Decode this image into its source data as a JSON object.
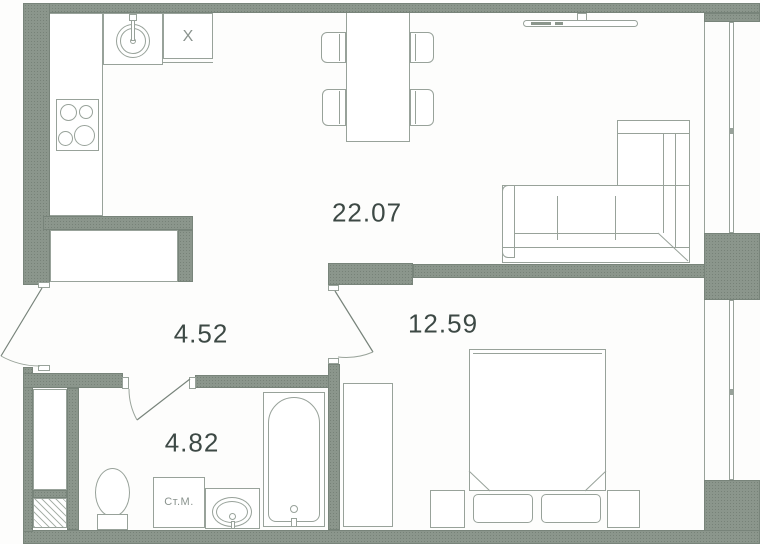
{
  "plan": {
    "rooms": {
      "living_kitchen": {
        "area": "22.07"
      },
      "bedroom": {
        "area": "12.59"
      },
      "hallway": {
        "area": "4.52"
      },
      "bathroom": {
        "area": "4.82"
      }
    },
    "labels": {
      "washing_machine": "Ст.М.",
      "kitchen_cabinet": "X"
    },
    "colors": {
      "wall": "#8b968c",
      "line": "#98a29a",
      "linedark": "#747f77",
      "text": "#3d4945",
      "muted": "#8a938e"
    }
  }
}
